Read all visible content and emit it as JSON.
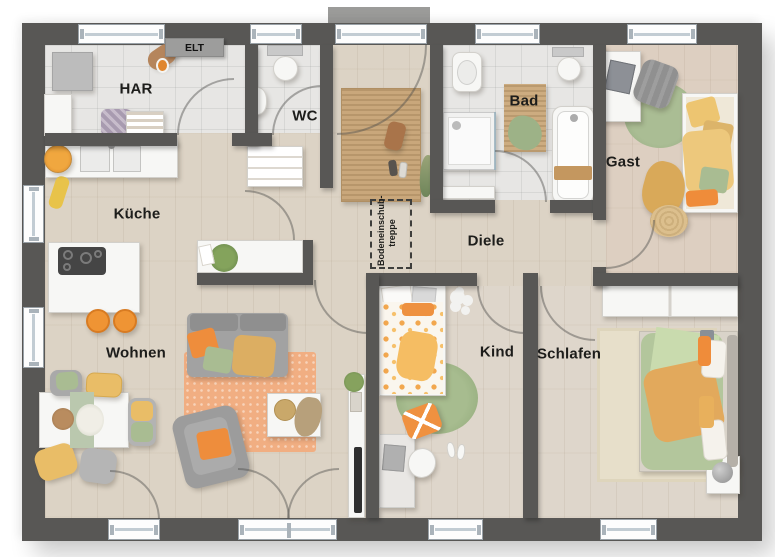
{
  "plan_title": "Bungalow floor plan",
  "rooms": {
    "har": {
      "label": "HAR"
    },
    "wc": {
      "label": "WC"
    },
    "kueche": {
      "label": "Küche"
    },
    "wohnen": {
      "label": "Wohnen"
    },
    "diele": {
      "label": "Diele"
    },
    "bad": {
      "label": "Bad"
    },
    "gast": {
      "label": "Gast"
    },
    "kind": {
      "label": "Kind"
    },
    "schlafen": {
      "label": "Schlafen"
    }
  },
  "annotations": {
    "elt_label": "ELT",
    "attic_stairs": {
      "line1": "Bodeneinschub-",
      "line2": "treppe"
    }
  },
  "colors": {
    "wall": "#585755",
    "floor_wood": "#dcd3c5",
    "floor_tile": "#e7e6e4",
    "accent_orange": "#ee8d3c",
    "accent_yellow": "#e7bc6a",
    "accent_green": "#a4b88e",
    "rug_jute": "#c9a77b"
  }
}
